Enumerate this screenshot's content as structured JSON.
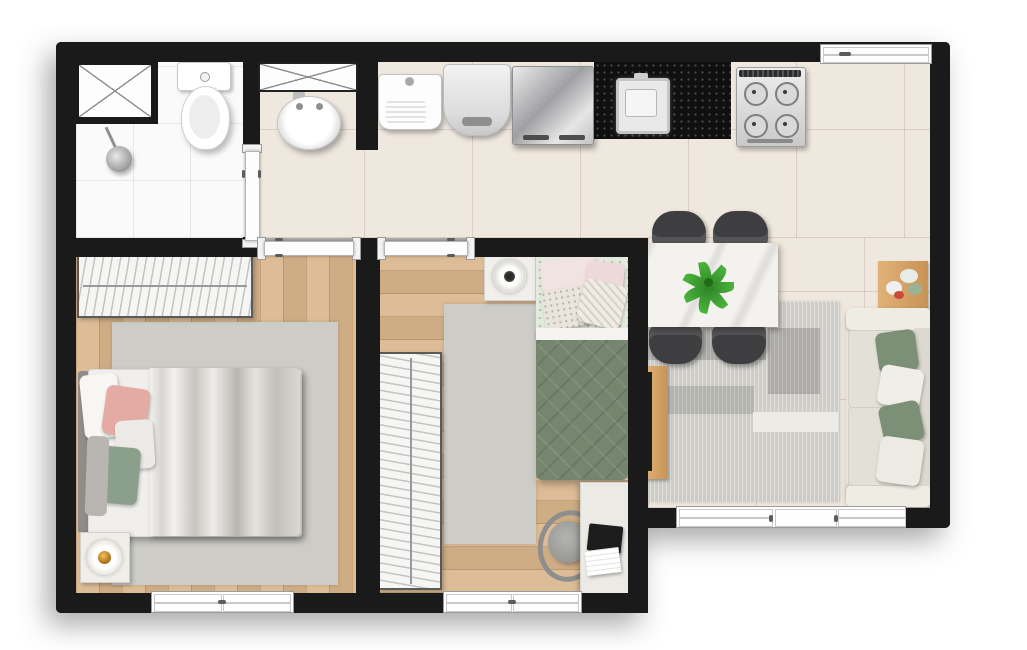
{
  "document": {
    "type": "apartment-floor-plan",
    "view": "top-down furnished render",
    "layout": "L-shaped one-level unit"
  },
  "palette": {
    "wall": "#1a1a1a",
    "bath_floor": "#fafafa",
    "tile_floor": "#efe8df",
    "wood_floor": "#d9b68c",
    "rug": "#cdccc7",
    "sofa": "#e7e4dc",
    "pillow_green": "#7b9077",
    "duvet_green": "#75866e",
    "counter_black": "#101010",
    "accent_wood": "#d8a76b",
    "plant_green": "#3a9a33",
    "lamp_amber": "#d99a2b",
    "chair_gray": "#3e3e40",
    "pink": "#e4aaa4"
  },
  "rooms": {
    "bathroom": {
      "name": "Bathroom",
      "items": {
        "shaft": "ventilation shaft",
        "shower": "shower head",
        "toilet": "toilet",
        "door": "bathroom door"
      }
    },
    "hall": {
      "name": "Hall",
      "items": {
        "shaft": "ventilation shaft",
        "sink": "pedestal washbasin"
      }
    },
    "kitchen": {
      "name": "Kitchen and laundry",
      "items": {
        "tank": "laundry tank",
        "washer": "washing machine",
        "fridge": "refrigerator",
        "counter": "black granite countertop",
        "sink": "kitchen sink",
        "stove": "4-burner stove",
        "window": "kitchen window"
      }
    },
    "living": {
      "name": "Living and dining room",
      "items": {
        "table": "marble dining table",
        "chair": "dining chair",
        "plant": "table plant",
        "rug": "striped area rug",
        "tv": "TV on wood rack",
        "side_table": "side table with flowers",
        "sofa": "sofa with pillows",
        "window": "balcony sliding window"
      }
    },
    "bedroom1": {
      "name": "Bedroom 1",
      "items": {
        "wardrobe": "open wardrobe with hangers",
        "bed": "double bed",
        "nightstand": "nightstand with lamp",
        "rug": "rug",
        "door": "bedroom door",
        "window": "window"
      }
    },
    "bedroom2": {
      "name": "Bedroom 2",
      "items": {
        "wardrobe": "open wardrobe with hangers",
        "bed": "single bed",
        "nightstand": "nightstand with lamp",
        "desk": "desk with laptop",
        "chair": "desk chair",
        "rug": "rug",
        "door": "bedroom door",
        "window": "window"
      }
    }
  }
}
